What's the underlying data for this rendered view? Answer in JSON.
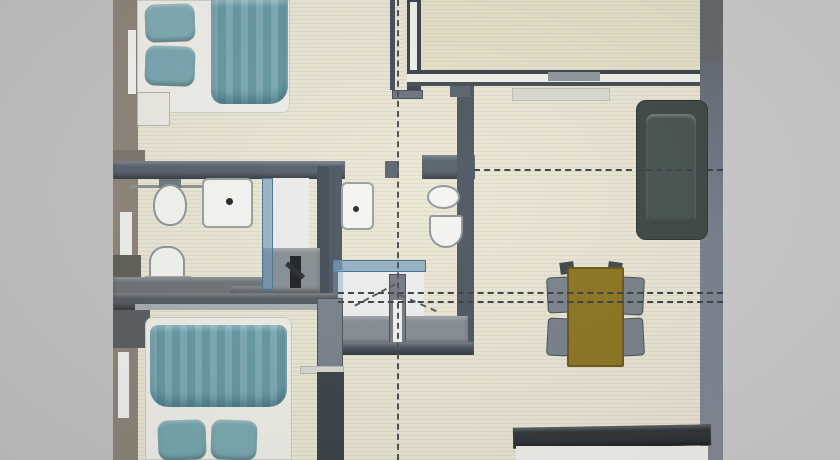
{
  "meta": {
    "description": "Photo of a 3D rendered top-down apartment floor plan; no visible text in the image",
    "canvas": {
      "width": 840,
      "height": 460
    }
  },
  "palette": {
    "photo_margin_left": "#c3c2c1",
    "photo_margin_right": "#cbcbcb",
    "floor_cream": "#ebe7d5",
    "floor_terrace": "#e7e2cb",
    "wall_dark_bluegray": "#4c5662",
    "wall_taupe": "#8e8478",
    "fixture_white": "#f4f4f1",
    "bedding_teal": "#6fa3ad",
    "sofa_dark": "#3d4845",
    "table_olive": "#8d7522",
    "chair_gray": "#79828a",
    "glass_blue": "rgba(103,149,183,0.6)",
    "counter_dark": "#30353a"
  },
  "scene": {
    "elements": [
      {
        "name": "photo-margin-left",
        "x": 0,
        "y": 0,
        "w": 113,
        "h": 460,
        "bg": "#c3c2c1"
      },
      {
        "name": "photo-margin-right",
        "x": 723,
        "y": 0,
        "w": 117,
        "h": 460,
        "bg": "#cbcbcb"
      },
      {
        "name": "floor-main",
        "x": 113,
        "y": 0,
        "w": 610,
        "h": 460,
        "bg": "#ebe7d5",
        "kind": "floor"
      },
      {
        "name": "floor-terrace-room",
        "x": 405,
        "y": 0,
        "w": 318,
        "h": 78,
        "bg": "#e7e2cb",
        "kind": "floor"
      },
      {
        "name": "wall-left-outer",
        "x": 113,
        "y": 0,
        "w": 25,
        "h": 460,
        "bg": "#8e8478"
      },
      {
        "name": "window-left-top",
        "x": 128,
        "y": 30,
        "w": 8,
        "h": 64,
        "bg": "#f4f3ef"
      },
      {
        "name": "wall-left-ledge",
        "x": 113,
        "y": 150,
        "w": 32,
        "h": 16,
        "bg": "#7c766c"
      },
      {
        "name": "window-left-middle",
        "x": 120,
        "y": 212,
        "w": 12,
        "h": 46,
        "bg": "#f1f0ec"
      },
      {
        "name": "wall-left-dark-block",
        "x": 113,
        "y": 255,
        "w": 28,
        "h": 50,
        "bg": "#616058"
      },
      {
        "name": "wall-left-dark-block-2",
        "x": 113,
        "y": 300,
        "w": 37,
        "h": 48,
        "bg": "#5a5e60"
      },
      {
        "name": "window-left-bottom",
        "x": 118,
        "y": 352,
        "w": 11,
        "h": 66,
        "bg": "#f0f1ed"
      },
      {
        "name": "bed-1-frame",
        "x": 137,
        "y": 0,
        "w": 153,
        "h": 113,
        "bg": "#f0efe9",
        "radius": "0 0 8px 8px",
        "border": "1px solid #d2cfc6"
      },
      {
        "name": "bed-1-pillow-top",
        "x": 145,
        "y": 4,
        "w": 50,
        "h": 38,
        "bg": "#7fabb3",
        "radius": "10px",
        "rotate": -2,
        "kind": "soft"
      },
      {
        "name": "bed-1-pillow-bottom",
        "x": 145,
        "y": 46,
        "w": 50,
        "h": 40,
        "bg": "#79a7b0",
        "radius": "10px",
        "rotate": 2,
        "kind": "soft"
      },
      {
        "name": "bed-1-duvet",
        "x": 211,
        "y": 0,
        "w": 77,
        "h": 104,
        "bg": "#6da2ad",
        "radius": "0 0 18px 12px",
        "kind": "duvet"
      },
      {
        "name": "nightstand-1",
        "x": 137,
        "y": 92,
        "w": 33,
        "h": 34,
        "bg": "#edebe4",
        "border": "1px solid #b8b5ac"
      },
      {
        "name": "wall-bathroom1-top",
        "x": 113,
        "y": 161,
        "w": 232,
        "h": 18,
        "bg": "#57616d",
        "kind": "wall3d"
      },
      {
        "name": "towel-rail",
        "x": 130,
        "y": 185,
        "w": 122,
        "h": 3,
        "bg": "#8e9296"
      },
      {
        "name": "door-jamb-bathrooms",
        "x": 385,
        "y": 161,
        "w": 14,
        "h": 17,
        "bg": "#5a636e"
      },
      {
        "name": "wall-bathroom2-top",
        "x": 422,
        "y": 155,
        "w": 53,
        "h": 24,
        "bg": "#57616d",
        "kind": "wall3d"
      },
      {
        "name": "toilet-1-tank",
        "x": 159,
        "y": 179,
        "w": 22,
        "h": 9,
        "bg": "#707880"
      },
      {
        "name": "toilet-1",
        "x": 153,
        "y": 184,
        "w": 34,
        "h": 42,
        "bg": "#f4f4f1",
        "radius": "50% 50% 46% 46%",
        "border": "2px solid #8f959a"
      },
      {
        "name": "sink-1",
        "x": 202,
        "y": 178,
        "w": 51,
        "h": 50,
        "bg": "#f5f5f2",
        "radius": "6px",
        "border": "2px solid #9ba09b"
      },
      {
        "name": "sink-1-drain",
        "x": 226,
        "y": 198,
        "w": 7,
        "h": 7,
        "bg": "#23262a",
        "radius": "50%"
      },
      {
        "name": "toilet-2",
        "x": 149,
        "y": 246,
        "w": 36,
        "h": 44,
        "bg": "#f4f4f1",
        "radius": "16px 16px 6px 6px",
        "border": "2px solid #8f959a"
      },
      {
        "name": "toilet-2-base",
        "x": 145,
        "y": 276,
        "w": 46,
        "h": 12,
        "bg": "#e8e7e0",
        "border": "1px solid #a9aaa2"
      },
      {
        "name": "counter-bathroom1",
        "x": 113,
        "y": 277,
        "w": 200,
        "h": 28,
        "bg": "#6d7378",
        "kind": "wall3d"
      },
      {
        "name": "counter-bathroom1-ext",
        "x": 230,
        "y": 286,
        "w": 106,
        "h": 20,
        "bg": "#5f666c",
        "kind": "wall3d"
      },
      {
        "name": "shower-1-right-wall",
        "x": 317,
        "y": 166,
        "w": 20,
        "h": 132,
        "bg": "#424d57"
      },
      {
        "name": "shower-1-interior",
        "x": 271,
        "y": 178,
        "w": 38,
        "h": 78,
        "bg": "#edeeec"
      },
      {
        "name": "shower-1-floor",
        "x": 262,
        "y": 248,
        "w": 58,
        "h": 46,
        "bg": "#899095",
        "kind": "wall3d"
      },
      {
        "name": "shower-1-glass",
        "x": 262,
        "y": 178,
        "w": 11,
        "h": 112,
        "bg": "rgba(103,149,183,0.6)",
        "border": "1px solid #4a7495"
      },
      {
        "name": "shower-1-column",
        "x": 290,
        "y": 256,
        "w": 11,
        "h": 32,
        "bg": "#1e2226"
      },
      {
        "name": "shower-1-arm",
        "x": 284,
        "y": 268,
        "w": 22,
        "h": 5,
        "bg": "#2a2e33",
        "rotate": 40
      },
      {
        "name": "wall-bathroom2-left",
        "x": 329,
        "y": 166,
        "w": 13,
        "h": 186,
        "bg": "#4d5863"
      },
      {
        "name": "sink-2",
        "x": 341,
        "y": 182,
        "w": 33,
        "h": 48,
        "bg": "#f5f5f2",
        "radius": "6px",
        "border": "2px solid #9ba09b"
      },
      {
        "name": "sink-2-drain",
        "x": 353,
        "y": 206,
        "w": 6,
        "h": 6,
        "bg": "#23262a",
        "radius": "50%"
      },
      {
        "name": "wall-bathroom2-right",
        "x": 457,
        "y": 86,
        "w": 17,
        "h": 266,
        "bg": "#4c5762"
      },
      {
        "name": "toilet-3",
        "x": 427,
        "y": 185,
        "w": 33,
        "h": 24,
        "bg": "#f4f4f1",
        "radius": "50%",
        "border": "2px solid #8f959a"
      },
      {
        "name": "bidet",
        "x": 429,
        "y": 215,
        "w": 34,
        "h": 33,
        "bg": "#f4f4f1",
        "radius": "3px 3px 17px 17px",
        "border": "2px solid #8f959a"
      },
      {
        "name": "shower-2-interior",
        "x": 338,
        "y": 270,
        "w": 86,
        "h": 52,
        "bg": "#eef0f0"
      },
      {
        "name": "shower-2-glass-top",
        "x": 333,
        "y": 260,
        "w": 93,
        "h": 12,
        "bg": "rgba(103,149,183,0.65)",
        "border": "1px solid #3f6c92"
      },
      {
        "name": "shower-2-glass-left",
        "x": 333,
        "y": 260,
        "w": 10,
        "h": 62,
        "bg": "rgba(120,160,190,0.4)"
      },
      {
        "name": "shower-2-floor-band",
        "x": 336,
        "y": 316,
        "w": 132,
        "h": 30,
        "bg": "#868d93",
        "kind": "wall3d"
      },
      {
        "name": "shower-2-partition",
        "x": 389,
        "y": 274,
        "w": 17,
        "h": 72,
        "bg": "#737b82",
        "border": "1px solid #4a5157"
      },
      {
        "name": "shower-2-partition-panel",
        "x": 393,
        "y": 300,
        "w": 9,
        "h": 44,
        "bg": "#f2f2f0"
      },
      {
        "name": "wall-bathroom2-bottom",
        "x": 330,
        "y": 342,
        "w": 144,
        "h": 13,
        "bg": "#4d5761",
        "kind": "wall3d"
      },
      {
        "name": "wall-hall-divider",
        "x": 390,
        "y": 0,
        "w": 5,
        "h": 90,
        "bg": "#454e57"
      },
      {
        "name": "entry-door-leaf",
        "x": 392,
        "y": 90,
        "w": 31,
        "h": 9,
        "bg": "#6c737b",
        "border": "1px solid #4a5158"
      },
      {
        "name": "entry-threshold",
        "x": 450,
        "y": 85,
        "w": 20,
        "h": 12,
        "bg": "#596470"
      },
      {
        "name": "wall-terrace-left",
        "x": 407,
        "y": 0,
        "w": 14,
        "h": 90,
        "bg": "#39434d"
      },
      {
        "name": "wall-terrace-left-core",
        "x": 410,
        "y": 2,
        "w": 7,
        "h": 84,
        "bg": "#f2f1e9"
      },
      {
        "name": "wall-terrace-bottom",
        "x": 407,
        "y": 70,
        "w": 316,
        "h": 16,
        "bg": "#f3f2e9",
        "borderTop": "4px solid #3b444e",
        "borderBottom": "4px solid #444d56"
      },
      {
        "name": "door-terrace",
        "x": 548,
        "y": 72,
        "w": 52,
        "h": 9,
        "bg": "#8f969c"
      },
      {
        "name": "doormat",
        "x": 512,
        "y": 88,
        "w": 98,
        "h": 13,
        "bg": "#dbdad2",
        "border": "1px solid #c2c1b8"
      },
      {
        "name": "pillar-top-right",
        "x": 700,
        "y": 0,
        "w": 23,
        "h": 62,
        "bg": "#64676c"
      },
      {
        "name": "wall-right",
        "x": 700,
        "y": 62,
        "w": 23,
        "h": 398,
        "bg": "#7b8290",
        "kind": "wallR"
      },
      {
        "name": "sofa",
        "x": 636,
        "y": 100,
        "w": 72,
        "h": 140,
        "bg": "#3d4845",
        "radius": "10px",
        "border": "1px solid #2c3532"
      },
      {
        "name": "sofa-seat",
        "x": 646,
        "y": 114,
        "w": 50,
        "h": 110,
        "bg": "#475350",
        "radius": "8px",
        "kind": "soft"
      },
      {
        "name": "chair-back-top-left",
        "x": 560,
        "y": 262,
        "w": 14,
        "h": 12,
        "bg": "#3f464c",
        "rotate": -8
      },
      {
        "name": "chair-back-top-right",
        "x": 608,
        "y": 262,
        "w": 14,
        "h": 12,
        "bg": "#3f464c",
        "rotate": 8
      },
      {
        "name": "chair-left-1",
        "x": 547,
        "y": 277,
        "w": 23,
        "h": 36,
        "bg": "#7a838b",
        "radius": "4px",
        "border": "1px solid #474e55",
        "rotate": -3
      },
      {
        "name": "chair-left-2",
        "x": 547,
        "y": 318,
        "w": 23,
        "h": 38,
        "bg": "#78818a",
        "radius": "4px",
        "border": "1px solid #474e55",
        "rotate": 3
      },
      {
        "name": "chair-right-1",
        "x": 620,
        "y": 277,
        "w": 24,
        "h": 38,
        "bg": "#79828a",
        "radius": "4px",
        "border": "1px solid #474e55",
        "rotate": 3
      },
      {
        "name": "chair-right-2",
        "x": 620,
        "y": 318,
        "w": 24,
        "h": 38,
        "bg": "#78818a",
        "radius": "4px",
        "border": "1px solid #474e55",
        "rotate": -3
      },
      {
        "name": "dining-table",
        "x": 567,
        "y": 267,
        "w": 57,
        "h": 100,
        "bg": "#8d7522",
        "radius": "2px",
        "border": "2px solid #6a5717"
      },
      {
        "name": "kitchen-counter-top",
        "x": 513,
        "y": 426,
        "w": 198,
        "h": 21,
        "bg": "#30353a",
        "rotate": -1,
        "kind": "wall3d"
      },
      {
        "name": "kitchen-counter-front",
        "x": 516,
        "y": 446,
        "w": 192,
        "h": 14,
        "bg": "#f2f0eb"
      },
      {
        "name": "wall-bedroom2-top",
        "x": 113,
        "y": 293,
        "w": 224,
        "h": 17,
        "bg": "#565d63",
        "kind": "wall3d"
      },
      {
        "name": "ledge-bedroom2-top",
        "x": 135,
        "y": 304,
        "w": 185,
        "h": 6,
        "bg": "#a9afb1"
      },
      {
        "name": "wardrobe-bedroom2",
        "x": 317,
        "y": 298,
        "w": 26,
        "h": 70,
        "bg": "#79828c",
        "border": "1px solid #4b545e"
      },
      {
        "name": "shelf-bedroom2",
        "x": 300,
        "y": 366,
        "w": 44,
        "h": 8,
        "bg": "#d9d9d3",
        "border": "1px solid #b9b9b1"
      },
      {
        "name": "wall-bedroom2-right",
        "x": 317,
        "y": 372,
        "w": 27,
        "h": 88,
        "bg": "#3a434b"
      },
      {
        "name": "bed-2-frame",
        "x": 145,
        "y": 317,
        "w": 147,
        "h": 143,
        "bg": "#efeee7",
        "radius": "8px 8px 0 0",
        "border": "1px solid #cfccc2"
      },
      {
        "name": "bed-2-duvet",
        "x": 150,
        "y": 325,
        "w": 137,
        "h": 82,
        "bg": "#6ea2ad",
        "radius": "8px 8px 18px 18px",
        "kind": "duvet"
      },
      {
        "name": "bed-2-pillow-left",
        "x": 158,
        "y": 420,
        "w": 48,
        "h": 40,
        "bg": "#76a7af",
        "radius": "10px",
        "rotate": -2,
        "kind": "soft"
      },
      {
        "name": "bed-2-pillow-right",
        "x": 211,
        "y": 420,
        "w": 46,
        "h": 40,
        "bg": "#7aa9b1",
        "radius": "10px",
        "rotate": 2,
        "kind": "soft"
      },
      {
        "name": "door-swing-dash-1",
        "x": 352,
        "y": 294,
        "w": 46,
        "h": 0,
        "borderTop": "2px dashed #555a60",
        "rotate": -28
      },
      {
        "name": "door-swing-dash-2",
        "x": 398,
        "y": 302,
        "w": 40,
        "h": 0,
        "borderTop": "2px dashed #555a60",
        "rotate": 24
      },
      {
        "name": "section-line-vertical",
        "x": 397,
        "y": 0,
        "w": 0,
        "h": 460,
        "borderLeft": "2px dashed #4a4f54"
      },
      {
        "name": "section-line-h1",
        "x": 474,
        "y": 169,
        "w": 249,
        "h": 0,
        "borderTop": "2px dashed #3c4146"
      },
      {
        "name": "section-line-h2",
        "x": 338,
        "y": 292,
        "w": 385,
        "h": 0,
        "borderTop": "2px dashed #3c4146"
      },
      {
        "name": "section-line-h3",
        "x": 338,
        "y": 301,
        "w": 385,
        "h": 0,
        "borderTop": "2px dashed #3c4146"
      }
    ]
  }
}
